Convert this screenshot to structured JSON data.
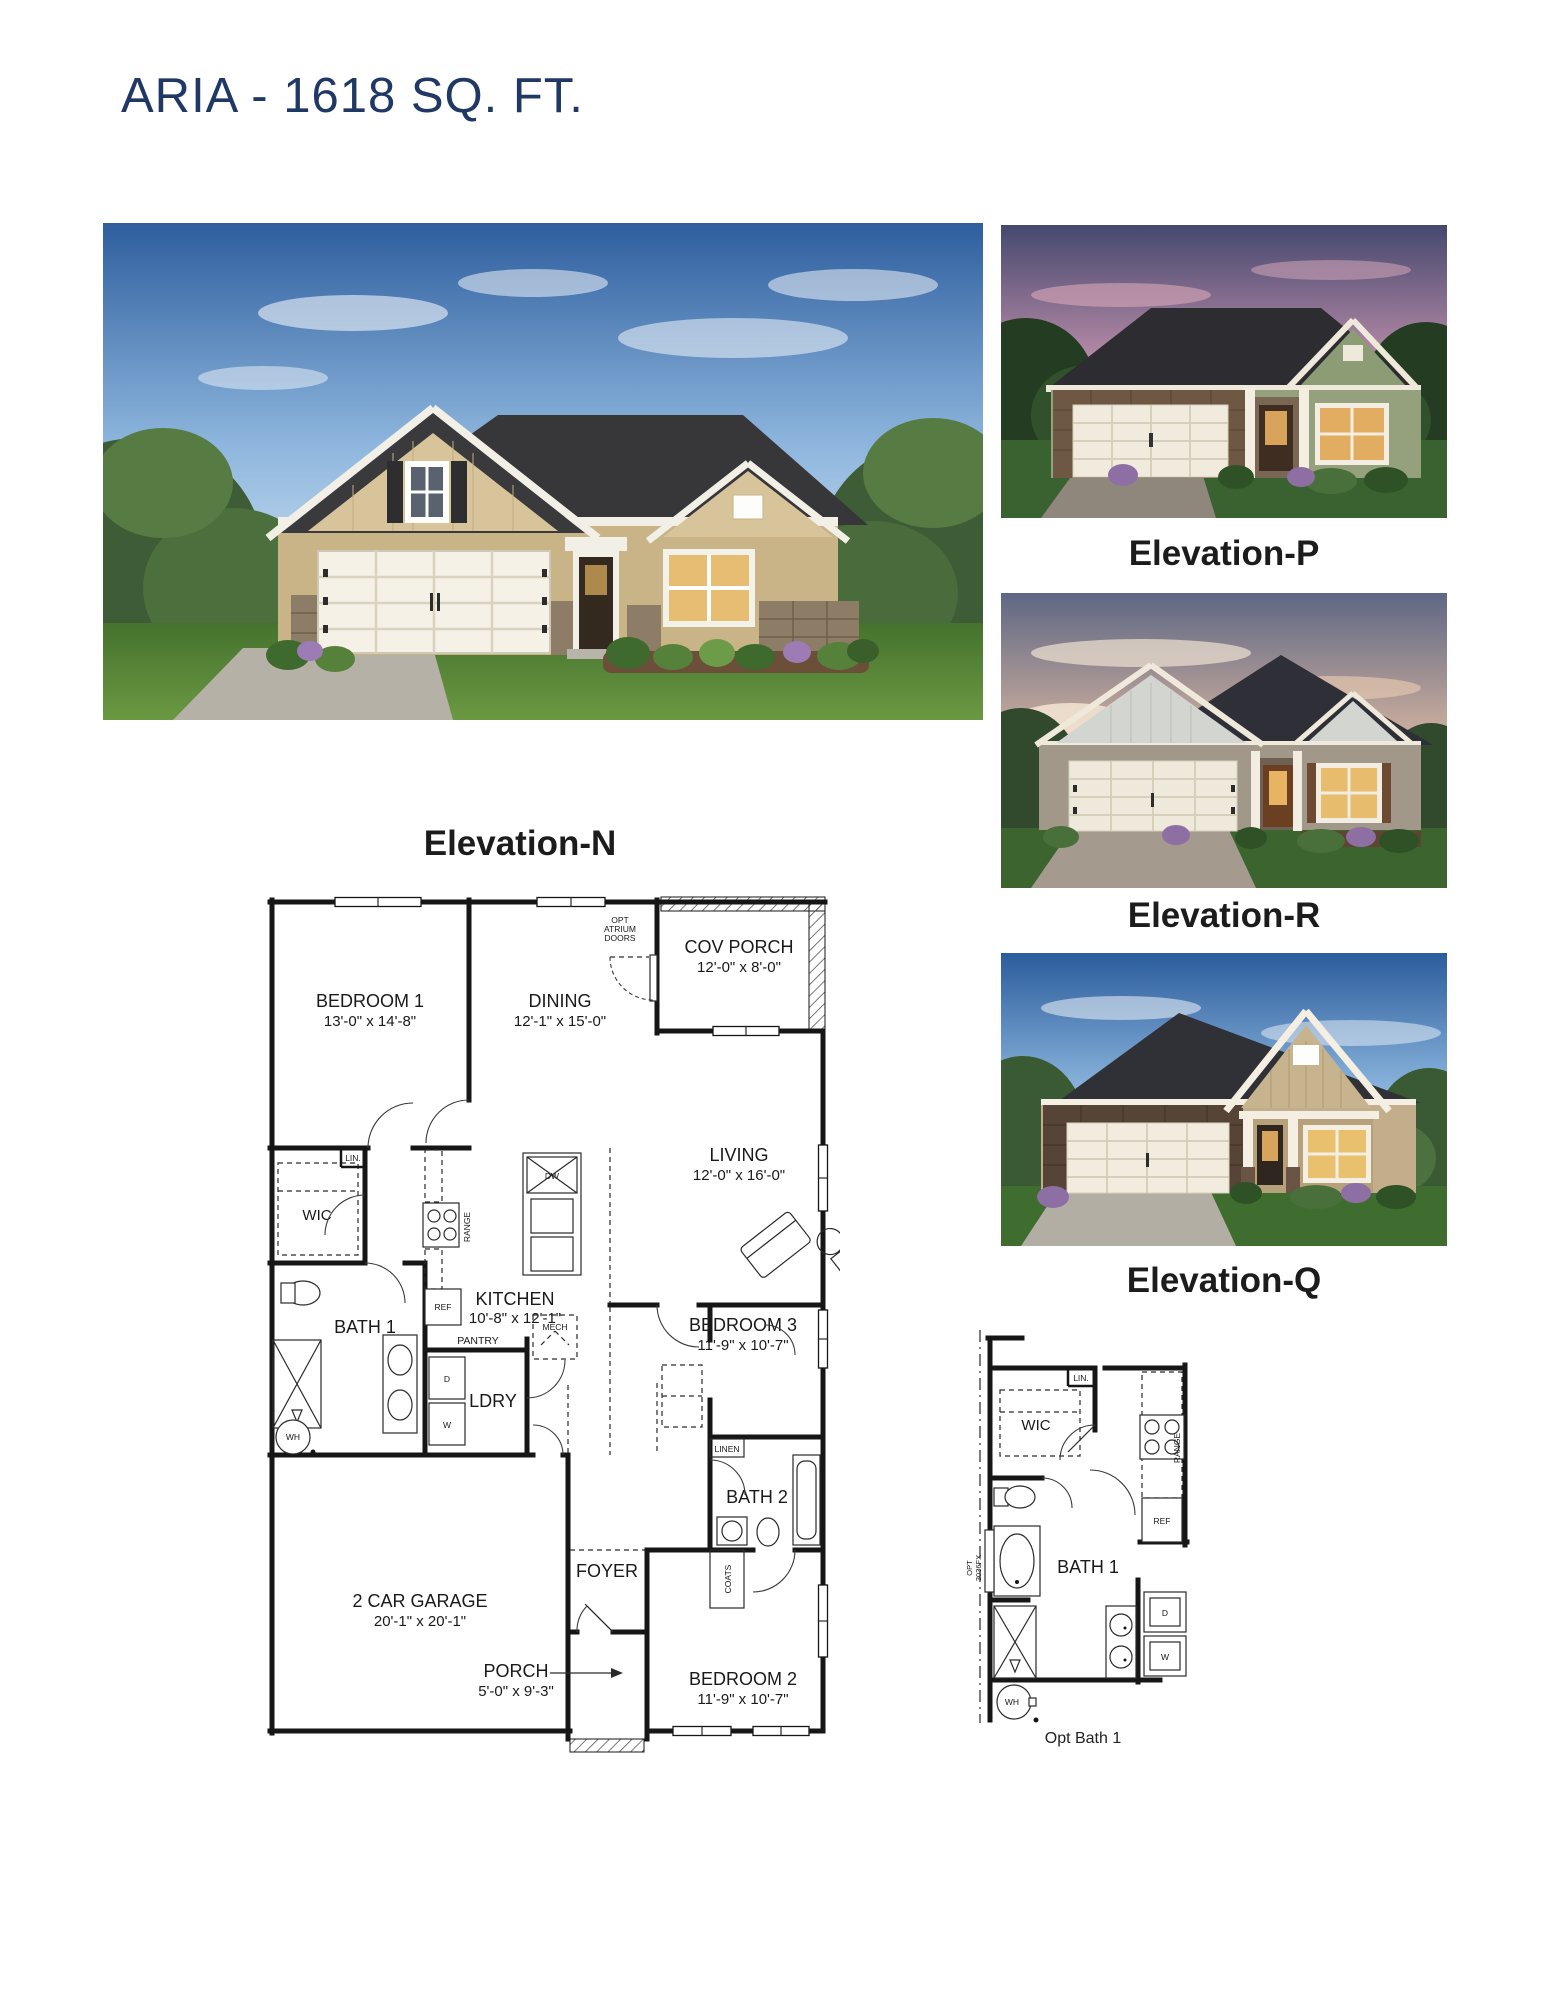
{
  "title": "ARIA - 1618 SQ. FT.",
  "colors": {
    "title_navy": "#1f3864",
    "plan_line": "#161616",
    "label_black": "#1c1c1c"
  },
  "elevations": {
    "main_label": "Elevation-N",
    "thumb_p_label": "Elevation-P",
    "thumb_r_label": "Elevation-R",
    "thumb_q_label": "Elevation-Q"
  },
  "plan": {
    "bedroom1": {
      "name": "BEDROOM 1",
      "dims": "13'-0\" x 14'-8\""
    },
    "dining": {
      "name": "DINING",
      "dims": "12'-1\" x 15'-0\""
    },
    "cov_porch": {
      "name": "COV PORCH",
      "dims": "12'-0\" x 8'-0\""
    },
    "living": {
      "name": "LIVING",
      "dims": "12'-0\" x 16'-0\""
    },
    "kitchen": {
      "name": "KITCHEN",
      "dims": "10'-8\" x 12'-1\""
    },
    "bedroom3": {
      "name": "BEDROOM 3",
      "dims": "11'-9\" x 10'-7\""
    },
    "bedroom2": {
      "name": "BEDROOM 2",
      "dims": "11'-9\" x 10'-7\""
    },
    "garage": {
      "name": "2 CAR GARAGE",
      "dims": "20'-1\" x 20'-1\""
    },
    "porch": {
      "name": "PORCH",
      "dims": "5'-0\" x 9'-3\""
    },
    "foyer": "FOYER",
    "wic": "WIC",
    "bath1": "BATH 1",
    "bath2": "BATH 2",
    "ldry": "LDRY",
    "pantry": "PANTRY",
    "mech": "MECH",
    "linen": "LINEN",
    "coats": "COATS",
    "lin": "LIN.",
    "range": "RANGE",
    "dw": "DW",
    "ref": "REF",
    "wh": "WH",
    "d": "D",
    "w": "W",
    "opt_atrium": {
      "l1": "OPT",
      "l2": "ATRIUM",
      "l3": "DOORS"
    }
  },
  "opt_bath": {
    "caption": "Opt Bath 1",
    "wic": "WIC",
    "lin": "LIN.",
    "range": "RANGE",
    "ref": "REF",
    "bath1": "BATH 1",
    "d": "D",
    "w": "W",
    "wh": "WH",
    "opt_fixture": {
      "l1": "OPT",
      "l2": "3036FX"
    }
  }
}
